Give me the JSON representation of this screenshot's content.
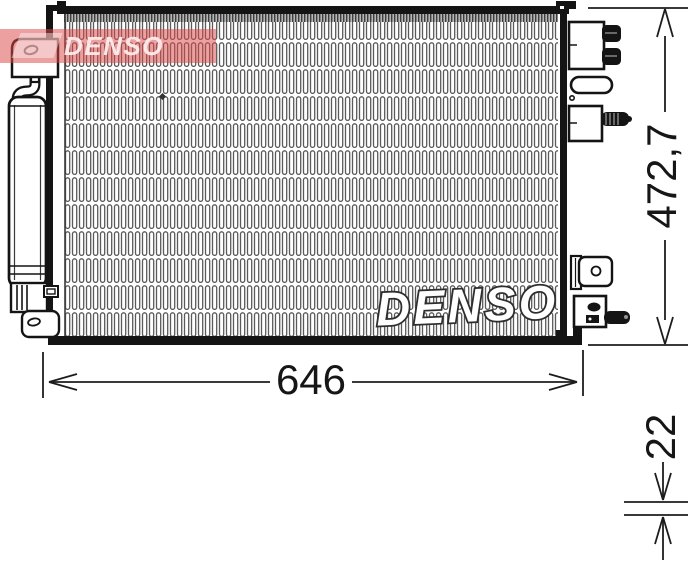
{
  "watermarks": {
    "corner_logo_text": "DENSO",
    "core_text": "DENSO"
  },
  "dimensions": {
    "width": "646",
    "height": "472,7",
    "depth": "22"
  },
  "colors": {
    "watermark_red": "#dd4848",
    "outline": "#1a1a1a",
    "fin_gray": "#5a5a5a"
  }
}
